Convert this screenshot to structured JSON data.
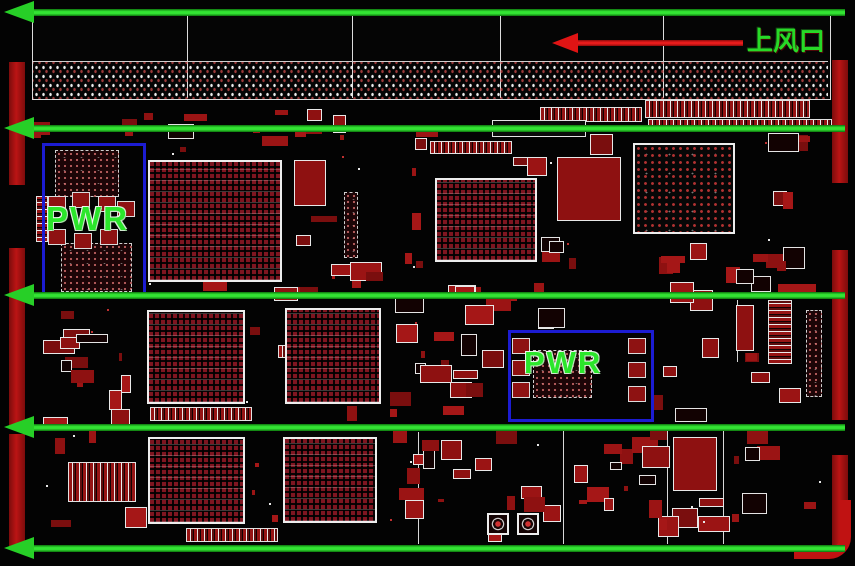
{
  "labels": {
    "top_vent": "上风口",
    "pwr": "PWR"
  },
  "colors": {
    "background": "#030303",
    "airflow_green": "#2ad82a",
    "vent_arrow_red": "#e01414",
    "outline_white": "#ececec",
    "component_red": "#8e1212",
    "bga_red": "#7e1520",
    "pwr_box_blue": "#1c1cd2",
    "pwr_text_green": "#2be62b",
    "edge_bar_red": "#bb1414"
  },
  "airflow_arrows": {
    "ys": [
      12,
      128,
      295,
      427,
      548
    ],
    "x_start": 4,
    "x_end": 845
  },
  "vent_arrow": {
    "y": 43,
    "tip_x": 552,
    "tail_x": 743,
    "label_x": 747,
    "label_y": 28
  },
  "top_connector": {
    "x": 32,
    "y": 13,
    "w": 797,
    "h": 85,
    "dividers_x": [
      187,
      352,
      500,
      663
    ],
    "grid_y": 61
  },
  "edge_bars": {
    "left": {
      "x": 9,
      "w": 16,
      "segments": [
        [
          62,
          185
        ],
        [
          248,
          428
        ],
        [
          434,
          548
        ]
      ]
    },
    "right": {
      "x": 832,
      "w": 16,
      "segments": [
        [
          60,
          183
        ],
        [
          250,
          420
        ],
        [
          455,
          548
        ]
      ]
    }
  },
  "bgas": [
    {
      "x": 148,
      "y": 160,
      "w": 130,
      "h": 118,
      "style": "dense"
    },
    {
      "x": 435,
      "y": 178,
      "w": 98,
      "h": 80,
      "style": "dense"
    },
    {
      "x": 633,
      "y": 143,
      "w": 98,
      "h": 87,
      "style": "sparse"
    },
    {
      "x": 147,
      "y": 310,
      "w": 94,
      "h": 90,
      "style": "dense"
    },
    {
      "x": 285,
      "y": 308,
      "w": 92,
      "h": 92,
      "style": "dense"
    },
    {
      "x": 148,
      "y": 437,
      "w": 93,
      "h": 83,
      "style": "dense"
    },
    {
      "x": 283,
      "y": 437,
      "w": 90,
      "h": 82,
      "style": "dense"
    }
  ],
  "pwr_zones": [
    {
      "x": 42,
      "y": 143,
      "w": 98,
      "h": 150,
      "label_x": 46,
      "label_y": 202,
      "font_px": 33,
      "dotcomps": [
        [
          55,
          150,
          62,
          45
        ],
        [
          61,
          243,
          69,
          47
        ]
      ],
      "pads": [
        [
          48,
          196
        ],
        [
          72,
          192
        ],
        [
          98,
          196
        ],
        [
          117,
          201
        ],
        [
          48,
          229
        ],
        [
          74,
          233
        ],
        [
          100,
          229
        ]
      ]
    },
    {
      "x": 508,
      "y": 330,
      "w": 140,
      "h": 86,
      "label_x": 524,
      "label_y": 347,
      "font_px": 31,
      "dotcomps": [
        [
          533,
          350,
          57,
          46
        ]
      ],
      "pads": [
        [
          512,
          338
        ],
        [
          512,
          360
        ],
        [
          512,
          382
        ],
        [
          628,
          338
        ],
        [
          628,
          362
        ],
        [
          628,
          386
        ]
      ]
    }
  ],
  "strips": [
    {
      "x": 540,
      "y": 107,
      "w": 100,
      "h": 13,
      "dir": "h"
    },
    {
      "x": 645,
      "y": 100,
      "w": 163,
      "h": 16,
      "dir": "h"
    },
    {
      "x": 648,
      "y": 119,
      "w": 182,
      "h": 11,
      "dir": "h"
    },
    {
      "x": 492,
      "y": 120,
      "w": 92,
      "h": 15,
      "dir": "h",
      "hollow": true
    },
    {
      "x": 150,
      "y": 407,
      "w": 100,
      "h": 12,
      "dir": "h"
    },
    {
      "x": 278,
      "y": 345,
      "w": 72,
      "h": 11,
      "dir": "h"
    },
    {
      "x": 186,
      "y": 528,
      "w": 90,
      "h": 12,
      "dir": "h"
    },
    {
      "x": 430,
      "y": 141,
      "w": 80,
      "h": 11,
      "dir": "h"
    },
    {
      "x": 68,
      "y": 462,
      "w": 66,
      "h": 38,
      "dir": "h"
    },
    {
      "x": 768,
      "y": 300,
      "w": 22,
      "h": 62,
      "dir": "v"
    },
    {
      "x": 36,
      "y": 196,
      "w": 10,
      "h": 44,
      "dir": "v"
    }
  ],
  "dot_components": [
    [
      806,
      310,
      14,
      85
    ],
    [
      344,
      192,
      12,
      64
    ]
  ],
  "big_blocks": [
    [
      557,
      157,
      62,
      62
    ],
    [
      673,
      437,
      42,
      52
    ],
    [
      736,
      305,
      16,
      44
    ],
    [
      294,
      160,
      30,
      44
    ]
  ],
  "key_components": [
    [
      487,
      513
    ],
    [
      517,
      513
    ]
  ],
  "corner_trace": {
    "x": 794,
    "y": 500,
    "w": 46,
    "h": 48
  },
  "silk_lines": [
    {
      "x": 418,
      "y": 432,
      "len": 112,
      "dir": "v"
    },
    {
      "x": 563,
      "y": 430,
      "len": 114,
      "dir": "v"
    },
    {
      "x": 667,
      "y": 428,
      "len": 116,
      "dir": "v"
    },
    {
      "x": 723,
      "y": 428,
      "len": 116,
      "dir": "v"
    },
    {
      "x": 737,
      "y": 300,
      "len": 62,
      "dir": "v"
    }
  ],
  "clutter": {
    "seed": 1337,
    "count": 185,
    "x_min": 28,
    "x_max": 824,
    "y_min": 100,
    "y_max": 540
  }
}
